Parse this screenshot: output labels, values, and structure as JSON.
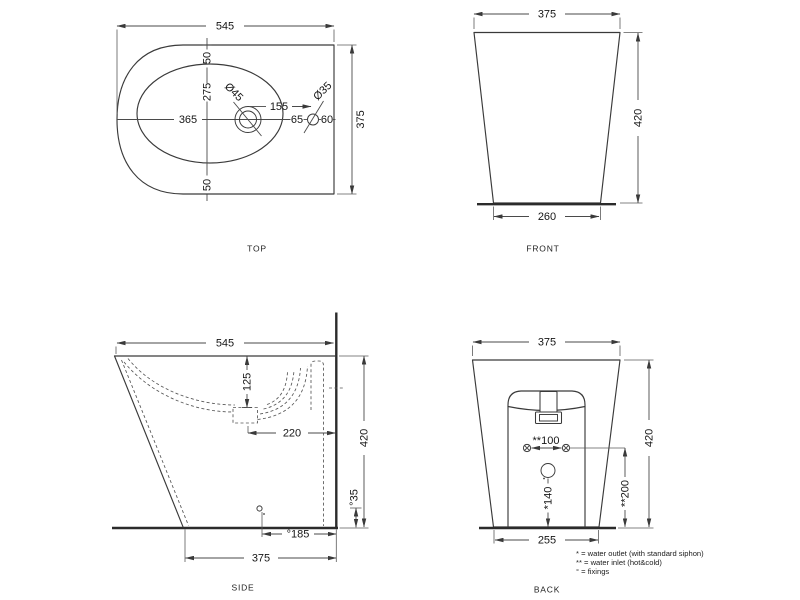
{
  "drawing": {
    "type": "technical-drawing",
    "subject": "floor-standing bidet, four orthographic views"
  },
  "top": {
    "title": "TOP",
    "width": "545",
    "height": "375",
    "margin_top": "50",
    "basin_length": "275",
    "margin_bottom": "50",
    "basin_width": "365",
    "tap_hole_dia": "Ø45",
    "hole_spacing": "155",
    "small_hole_dia": "Ø35",
    "d65": "65",
    "d60": "60"
  },
  "front": {
    "title": "FRONT",
    "width": "375",
    "height": "420",
    "base_width": "260"
  },
  "side": {
    "title": "SIDE",
    "depth": "545",
    "basin_depth": "125",
    "drain_offset": "220",
    "height": "420",
    "fixing_height": "°35",
    "fixing_offset": "°185",
    "base_depth": "375"
  },
  "back": {
    "title": "BACK",
    "width": "375",
    "height": "420",
    "inlet_spacing": "**100",
    "inlet_height": "**200",
    "outlet_height": "*140",
    "base_width": "255"
  },
  "legend": {
    "outlet": "* = water outlet (with standard siphon)",
    "inlet": "** = water inlet (hot&cold)",
    "fixings": "° = fixings"
  },
  "colors": {
    "line": "#3a3a3a",
    "background": "#ffffff"
  }
}
